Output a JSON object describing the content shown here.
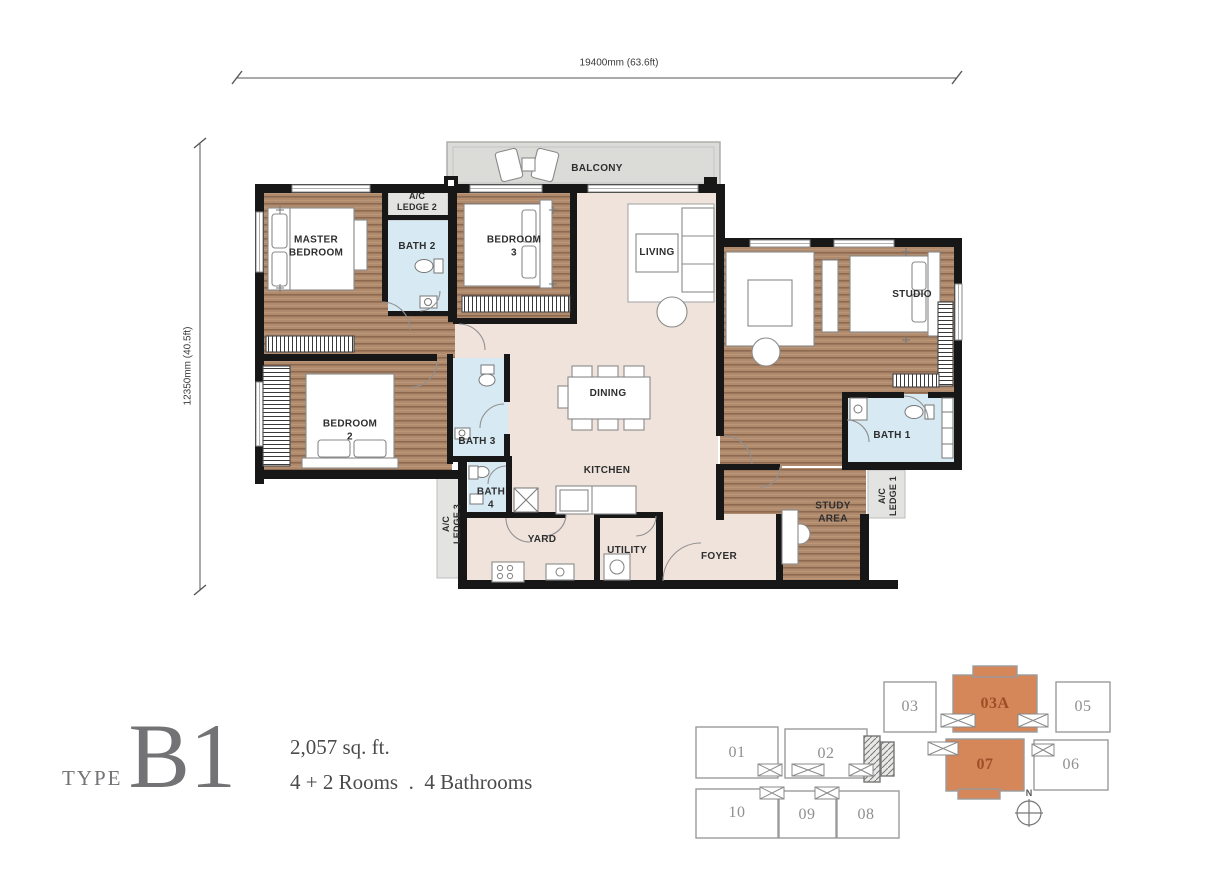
{
  "title_block": {
    "type_label": "TYPE",
    "type_code": "B1",
    "area_text": "2,057 sq. ft.",
    "config_text": "4 + 2 Rooms  .  4 Bathrooms"
  },
  "dimensions": {
    "horizontal": "19400mm (63.6ft)",
    "vertical": "12350mm (40.5ft)"
  },
  "rooms": {
    "balcony": "BALCONY",
    "master_bedroom": "MASTER\nBEDROOM",
    "ac_ledge_2": "A/C\nLEDGE 2",
    "bath_2": "BATH 2",
    "bedroom_3": "BEDROOM\n3",
    "living": "LIVING",
    "studio": "STUDIO",
    "dining": "DINING",
    "bedroom_2": "BEDROOM\n2",
    "bath_3": "BATH 3",
    "bath_1": "BATH 1",
    "kitchen": "KITCHEN",
    "bath_4": "BATH\n4",
    "ac_ledge_3": "A/C\nLEDGE 3",
    "yard": "YARD",
    "utility": "UTILITY",
    "foyer": "FOYER",
    "study_area": "STUDY\nAREA",
    "ac_ledge_1": "A/C\nLEDGE 1"
  },
  "key_plan": {
    "units": [
      {
        "id": "01",
        "label": "01",
        "highlighted": false
      },
      {
        "id": "02",
        "label": "02",
        "highlighted": false
      },
      {
        "id": "03",
        "label": "03",
        "highlighted": false
      },
      {
        "id": "03A",
        "label": "03A",
        "highlighted": true
      },
      {
        "id": "05",
        "label": "05",
        "highlighted": false
      },
      {
        "id": "06",
        "label": "06",
        "highlighted": false
      },
      {
        "id": "07",
        "label": "07",
        "highlighted": true
      },
      {
        "id": "08",
        "label": "08",
        "highlighted": false
      },
      {
        "id": "09",
        "label": "09",
        "highlighted": false
      },
      {
        "id": "10",
        "label": "10",
        "highlighted": false
      }
    ],
    "compass_label": "N",
    "highlight_color": "#D5875A",
    "highlight_text_color": "#9C4F26"
  },
  "colors": {
    "wall": "#171717",
    "wood_floor": "#AF8A6D",
    "wood_stripe": "#8D6950",
    "tile_floor": "#EFE3DC",
    "bath_floor": "#D7E9F3",
    "ledge_floor": "#E3E3E1",
    "balcony_floor": "#DBDBD8",
    "unit_outline": "#9B9B9B",
    "highlight": "#D5875A"
  }
}
